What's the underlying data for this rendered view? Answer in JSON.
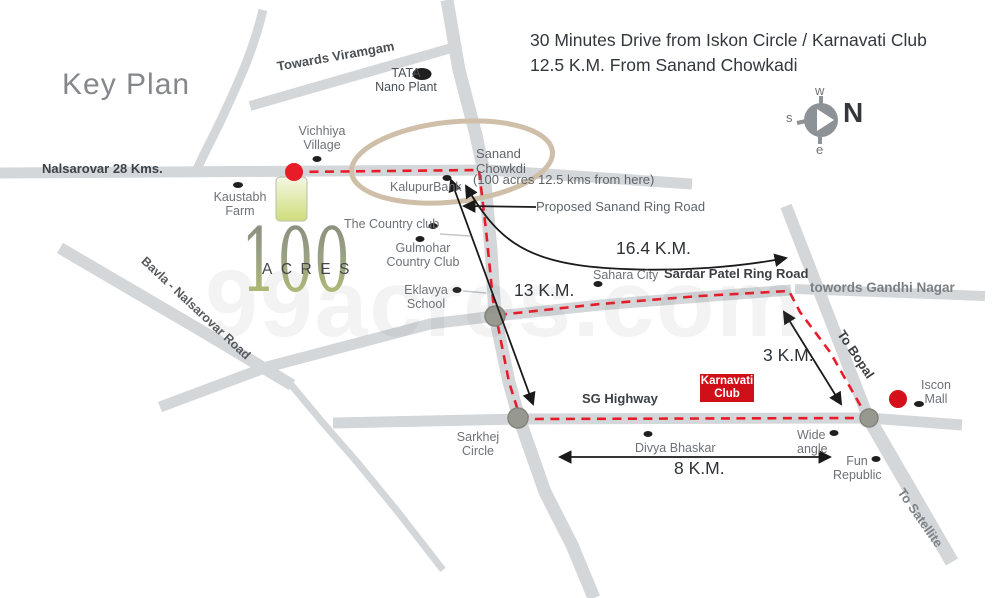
{
  "title": "Key Plan",
  "header": {
    "line1": "30 Minutes Drive from Iskon Circle / Karnavati Club",
    "line2": "12.5 K.M. From Sanand Chowkadi"
  },
  "compass": {
    "north": "N",
    "west": "w",
    "south": "s",
    "east": "e"
  },
  "watermark": "99acres.com",
  "site": {
    "big_number": "100",
    "acres_label": "ACRES"
  },
  "road_labels": {
    "nalsarovar": "Nalsarovar 28 Kms.",
    "towards_viramgam": "Towards Viramgam",
    "bavla": "Bavla - Nalsarovar Road",
    "sardar_patel": "Sardar Patel Ring Road",
    "sg_highway": "SG Highway",
    "gandhi_nagar": "towords Gandhi Nagar",
    "to_bopal": "To Bopal",
    "to_satellite": "To Satellite",
    "proposed_ring": "Proposed Sanand Ring Road"
  },
  "places": {
    "tata": {
      "line1": "TATA",
      "line2": "Nano Plant"
    },
    "vichhiya": {
      "line1": "Vichhiya",
      "line2": "Village"
    },
    "kaustabh": {
      "line1": "Kaustabh",
      "line2": "Farm"
    },
    "kalupur": "KalupurBank",
    "country_club": "The Country club",
    "gulmohar": {
      "line1": "Gulmohar",
      "line2": "Country Club"
    },
    "eklavya": {
      "line1": "Eklavya",
      "line2": "School"
    },
    "sahara": "Sahara City",
    "sanand": {
      "line1": "Sanand",
      "line2": "Chowkdi",
      "note": "(100 acres 12.5 kms from here)"
    },
    "sarkhej": {
      "line1": "Sarkhej",
      "line2": "Circle"
    },
    "divya": "Divya Bhaskar",
    "karnavati": {
      "line1": "Karnavati",
      "line2": "Club"
    },
    "iscon": {
      "line1": "Iscon",
      "line2": "Mall"
    },
    "wide_angle": {
      "line1": "Wide",
      "line2": "angle"
    },
    "fun_republic": {
      "line1": "Fun",
      "line2": "Republic"
    }
  },
  "distances": {
    "sanand_to_sarkhej": "13 K.M.",
    "sanand_to_ringroad": "16.4 K.M.",
    "ring_to_iscon": "3 K.M.",
    "sarkhej_to_iscon": "8 K.M."
  },
  "colors": {
    "road": "#d4d7da",
    "route_red": "#e81c29",
    "highlight_ellipse": "#cfbfa8",
    "site_green_top": "#f4f7e3",
    "site_green_bottom": "#cfdd7a",
    "karnavati_red": "#d01018"
  }
}
